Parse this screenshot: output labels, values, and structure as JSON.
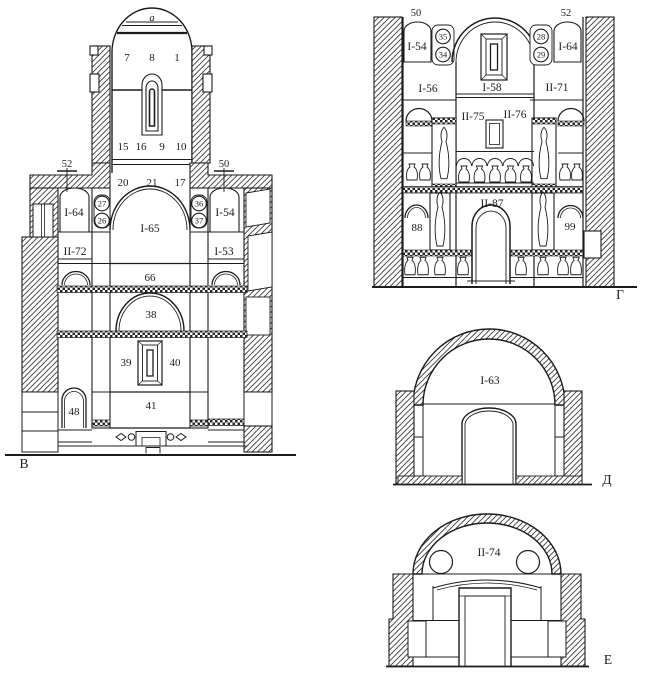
{
  "canvas": {
    "background": "#ffffff",
    "ink": "#1c1c1c"
  },
  "section_b": {
    "letter": "В",
    "apex": "a",
    "dome_1": "7",
    "dome_2": "8",
    "dome_3": "1",
    "drum_1": "15",
    "drum_2": "16",
    "drum_3": "9",
    "drum_4": "10",
    "mark_left": "52",
    "mark_right": "50",
    "gallery_1": "20",
    "gallery_2": "21",
    "gallery_3": "17",
    "niche_nw": "I-64",
    "circle_a": "27",
    "circle_b": "26",
    "vault": "I-65",
    "circle_c": "36",
    "circle_d": "37",
    "niche_ne": "I-54",
    "room_w": "II-72",
    "room_e": "I-53",
    "band": "66",
    "arch": "38",
    "pier_w": "39",
    "pier_e": "40",
    "nave": "41",
    "niche_sw": "48"
  },
  "section_g": {
    "letter": "Г",
    "mark_left": "50",
    "mark_right": "52",
    "niche_nw": "I-54",
    "circle_a": "35",
    "circle_b": "34",
    "vault": "I-58",
    "circle_c": "28",
    "circle_d": "29",
    "niche_ne": "I-64",
    "room_w": "I-56",
    "room_e": "II-71",
    "vault_w": "II-75",
    "vault_e": "II-76",
    "arch_w": "88",
    "hall": "II-87",
    "arch_e": "99"
  },
  "section_d": {
    "letter": "Д",
    "vault": "I-63"
  },
  "section_e": {
    "letter": "Е",
    "vault": "II-74"
  }
}
